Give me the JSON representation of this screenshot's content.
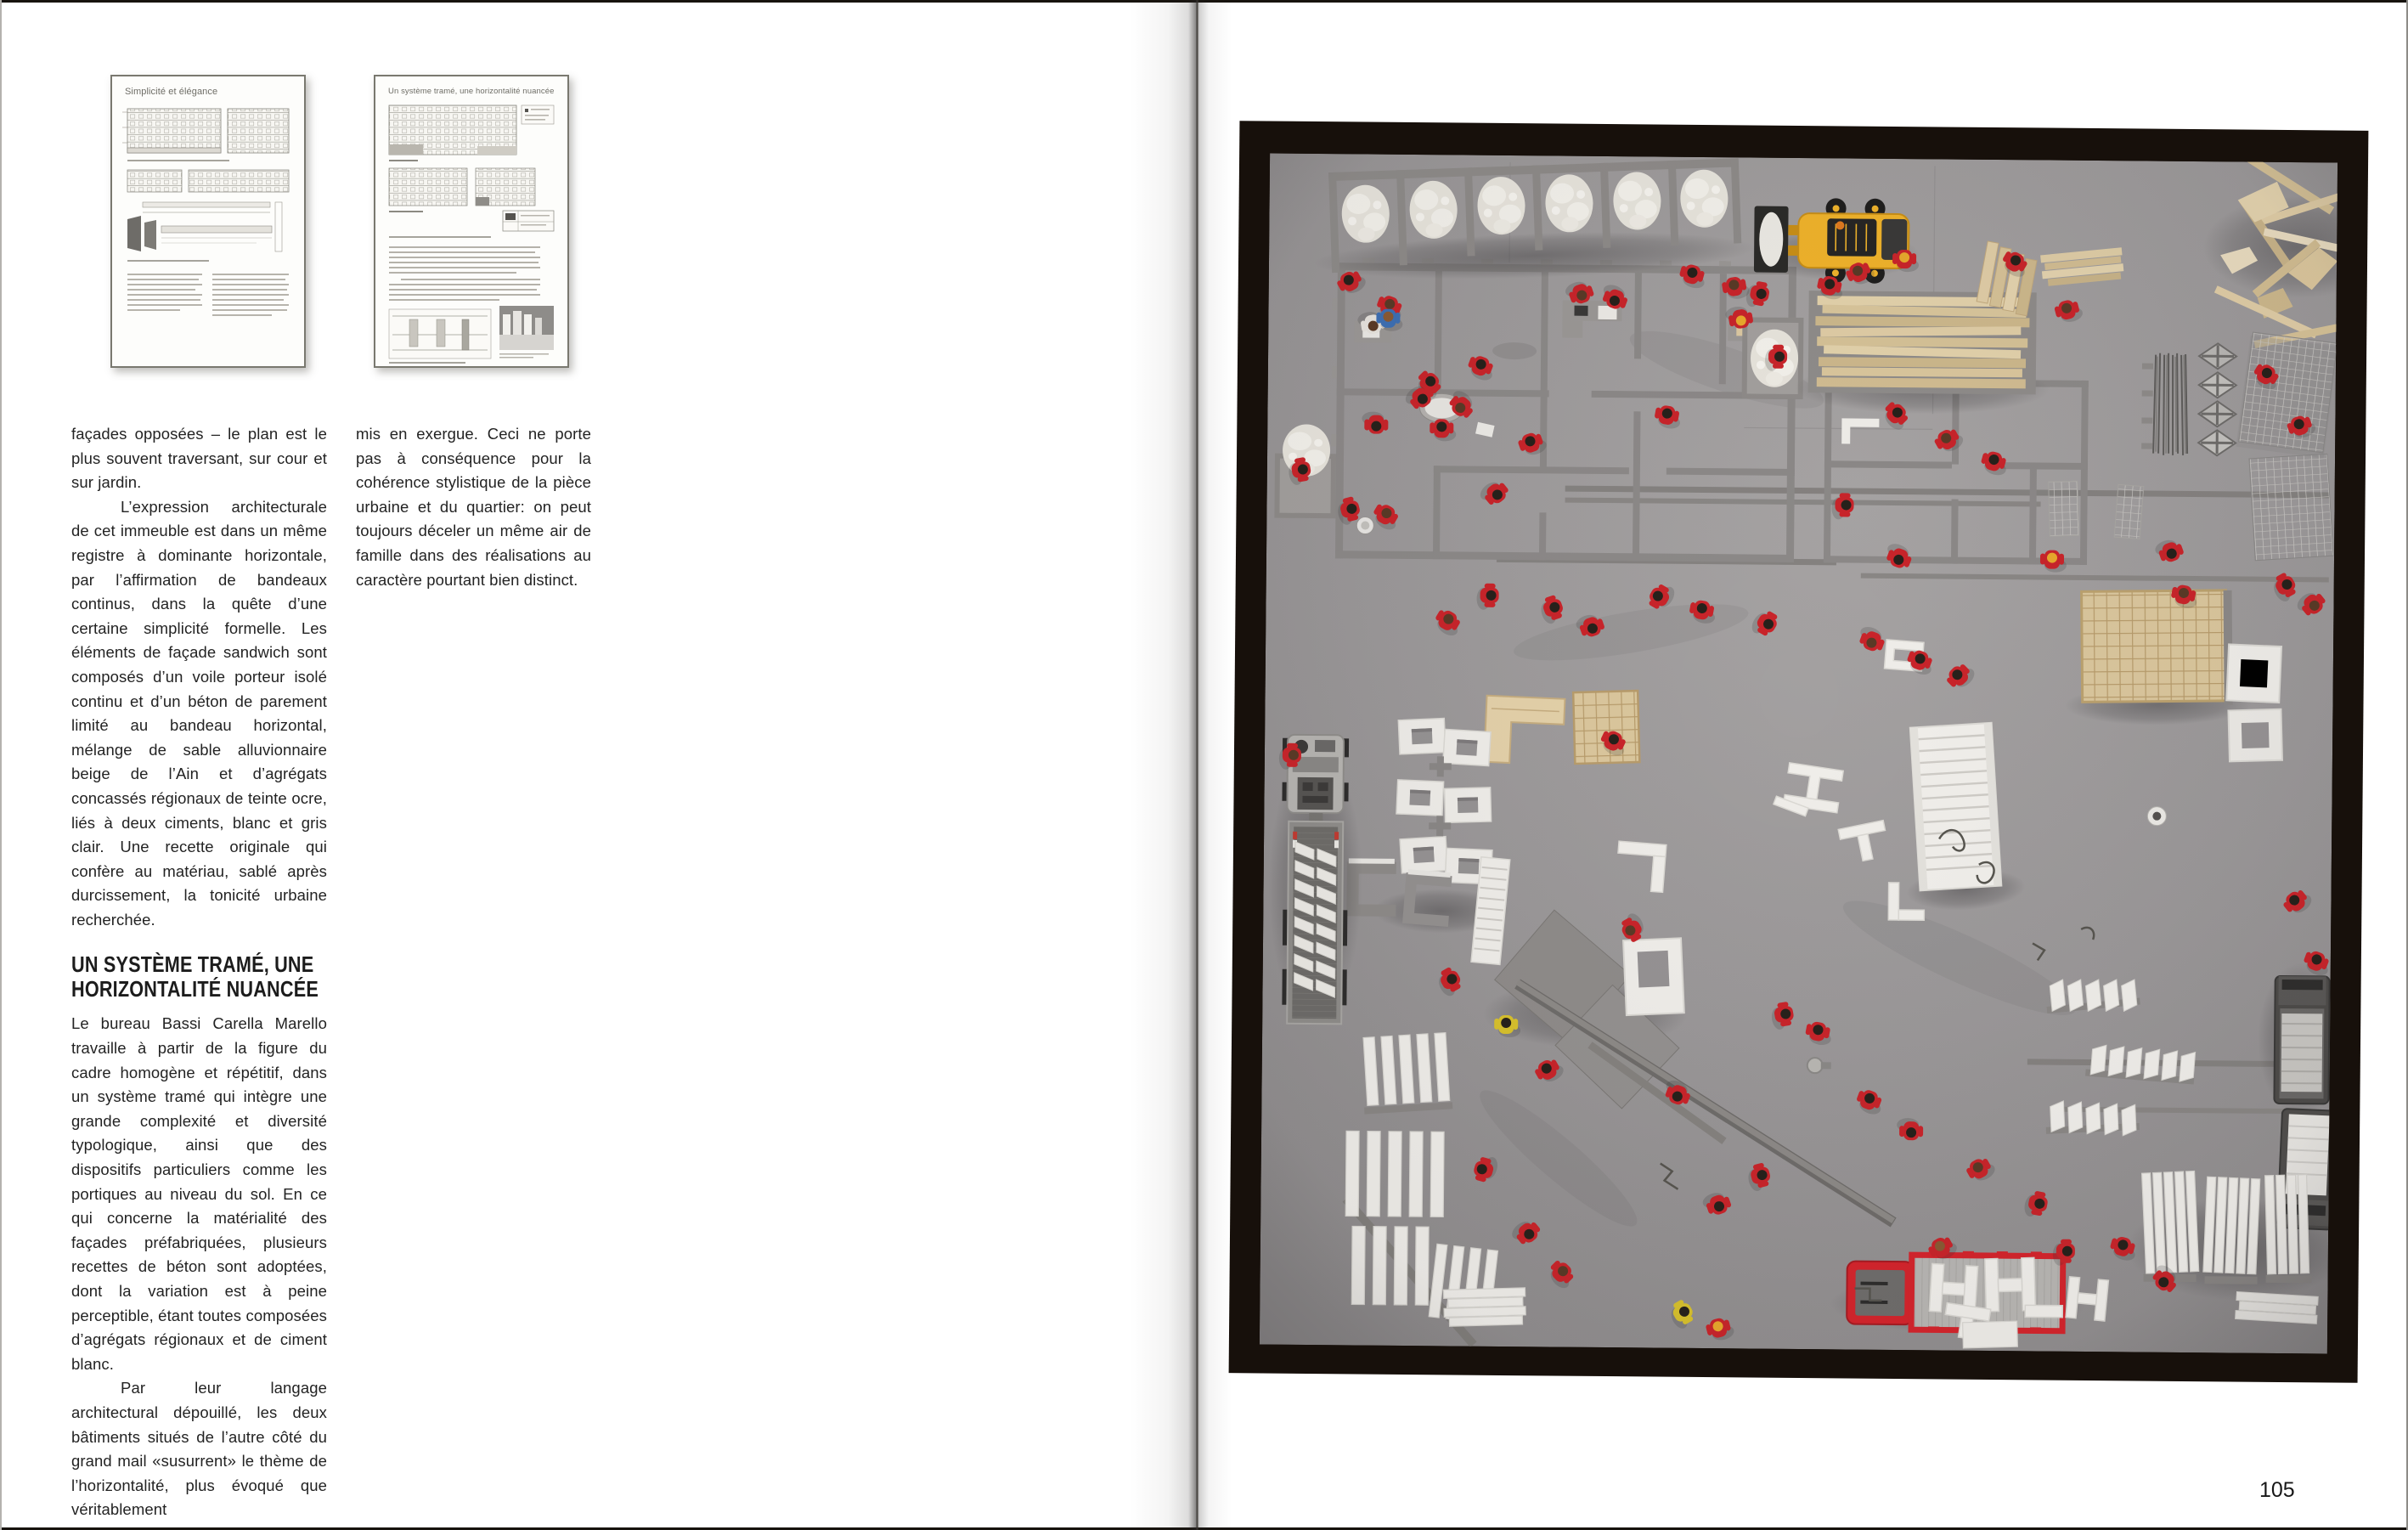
{
  "book": {
    "left_page": {
      "thumb1": {
        "title": "Simplicité et élégance"
      },
      "thumb2": {
        "title": "Un système tramé, une horizontalité nuancée"
      },
      "text": {
        "para1": "façades opposées – le plan est le plus souvent traversant, sur cour et sur jardin.",
        "para2": "L’expression architecturale de cet immeuble est dans un même registre à dominante horizontale, par l’affirmation de bandeaux continus, dans la quête d’une certaine simplicité formelle. Les éléments de façade sandwich sont composés d’un voile porteur isolé continu et d’un béton de parement limité au bandeau horizontal, mélange de sable alluvionnaire beige de l’Ain et d’agrégats concassés régionaux de teinte ocre, liés à deux ciments, blanc et gris clair. Une recette originale qui confère au matériau, sablé après durcissement, la tonicité urbaine recherchée.",
        "heading_line1": "UN SYSTÈME TRAMÉ, UNE",
        "heading_line2": "HORIZONTALITÉ NUANCÉE",
        "para3": "Le bureau Bassi Carella Marello travaille à partir de la figure du cadre homogène et répétitif, dans un système tramé qui intègre une grande complexité et diversité typologique, ainsi que des dispositifs particuliers comme les portiques au niveau du sol. En ce qui concerne la matérialité des façades préfabriquées, plusieurs recettes de béton sont adoptées, dont la variation est à peine perceptible, étant toutes composées d’agrégats régionaux et de ciment blanc.",
        "para4": "Par leur langage architectural dépouillé, les deux bâtiments situés de l’autre côté du grand mail «susurrent» le thème de l’horizontalité, plus évoqué que véritablement",
        "col2_para": "mis en exergue. Ceci ne porte pas à conséquence pour la cohérence stylistique de la pièce urbaine et du quartier: on peut toujours déceler un même air de famille dans des réalisations au caractère pourtant bien distinct."
      }
    },
    "right_page": {
      "page_number": "105",
      "photo": {
        "alt": "Top-down photograph of a gray architectural construction-site model with miniature red worker figures, toy machines, white precast elements and timber stacks",
        "palette": {
          "board_gray": "#9b9899",
          "frame_black": "#17100b",
          "figure_red": "#c9242a",
          "wood_beige": "#ddc9a0",
          "machine_yellow": "#f0b32b",
          "truck_red": "#d5242c",
          "element_white": "#f1efeb"
        }
      }
    }
  }
}
